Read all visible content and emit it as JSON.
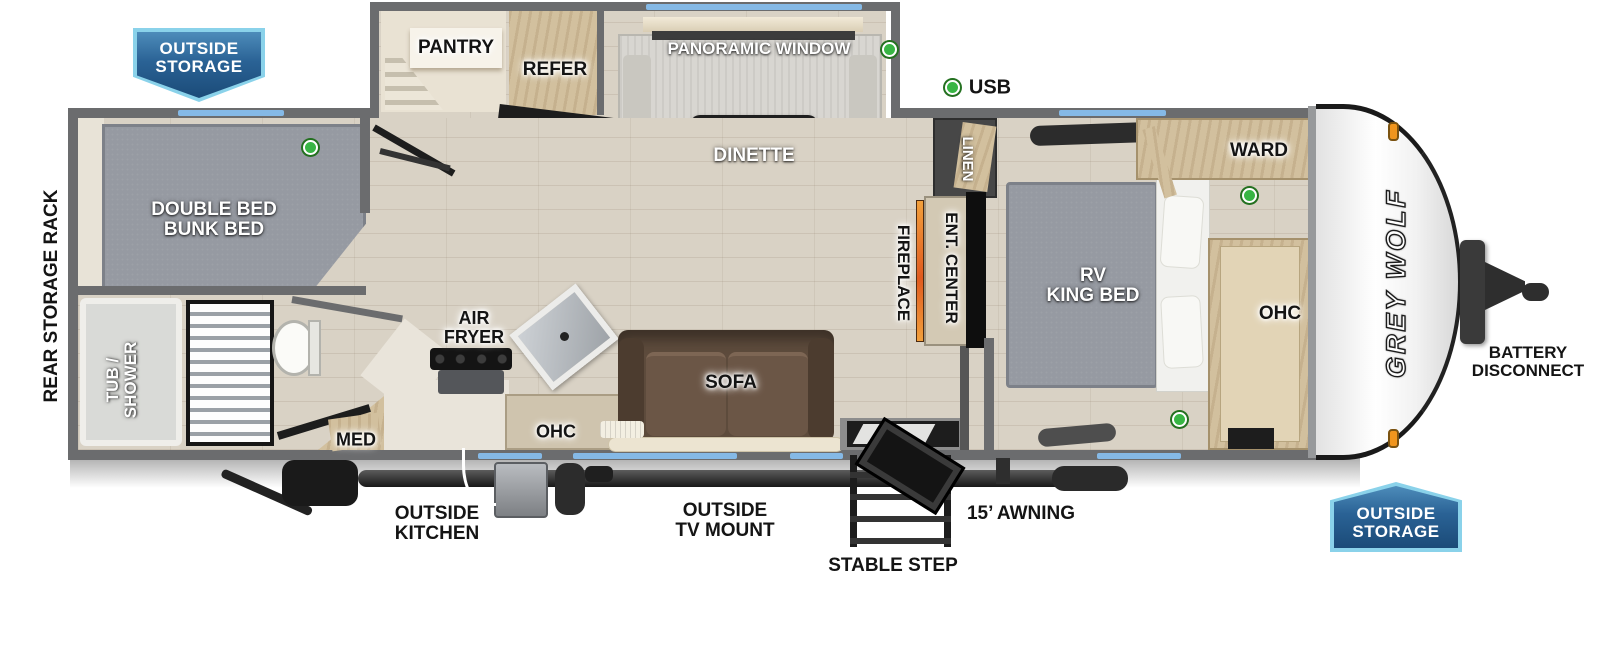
{
  "title": "Grey Wolf travel trailer floorplan",
  "brand": "GREY WOLF",
  "badge": {
    "line1": "OUTSIDE",
    "line2": "STORAGE"
  },
  "legend": {
    "usb": "USB"
  },
  "exterior": {
    "rear_storage_rack": "REAR STORAGE RACK",
    "battery_1": "BATTERY",
    "battery_2": "DISCONNECT",
    "outside_kitchen_1": "OUTSIDE",
    "outside_kitchen_2": "KITCHEN",
    "outside_tv_1": "OUTSIDE",
    "outside_tv_2": "TV MOUNT",
    "stable_step": "STABLE STEP",
    "awning": "15’ AWNING"
  },
  "rooms": {
    "pantry": "PANTRY",
    "refer": "REFER",
    "panoramic_window": "PANORAMIC WINDOW",
    "dinette": "DINETTE",
    "linen": "LINEN",
    "fireplace": "FIREPLACE",
    "ent_center": "ENT. CENTER",
    "ward": "WARD",
    "ohc": "OHC",
    "rv_king_1": "RV",
    "rv_king_2": "KING BED",
    "bunk_1": "DOUBLE BED",
    "bunk_2": "BUNK BED",
    "tub_1": "TUB /",
    "tub_2": "SHOWER",
    "med": "MED",
    "air_1": "AIR",
    "air_2": "FRYER",
    "sofa": "SOFA"
  },
  "colors": {
    "badge_blue": "#2a6295",
    "badge_border": "#8ad2ea",
    "wall_gray": "#6b6c6e",
    "window_blue": "#85b9e6",
    "usb_green": "#38b544",
    "fireplace_orange": "#e8681f",
    "sofa_brown": "#5d4b3c",
    "bed_gray": "#969aa2",
    "marker_orange": "#f0951e"
  }
}
